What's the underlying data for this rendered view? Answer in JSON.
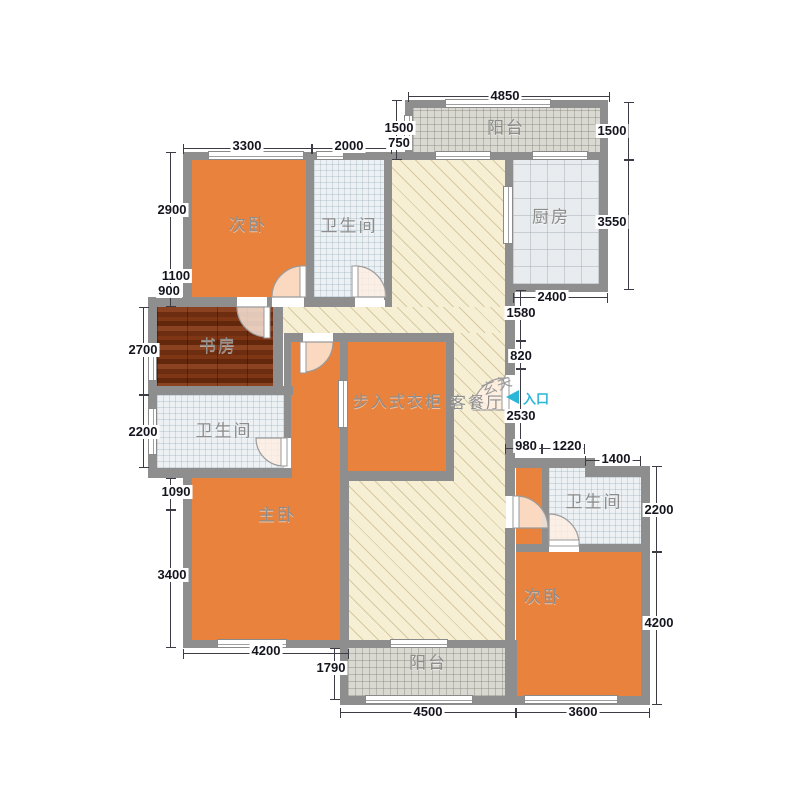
{
  "rooms": {
    "bedroom1": "次卧",
    "bath1": "卫生间",
    "balcony_top": "阳台",
    "kitchen": "厨房",
    "study": "书房",
    "bath2": "卫生间",
    "closet": "步入式衣柜",
    "living": "客餐厅",
    "foyer": "玄关",
    "entry": "入口",
    "master": "主卧",
    "bath3": "卫生间",
    "bedroom2": "次卧",
    "balcony_bottom": "阳台"
  },
  "dims": {
    "w4850": "4850",
    "h1500l": "1500",
    "h750": "750",
    "w3300": "3300",
    "w2000": "2000",
    "h1500r": "1500",
    "h2900": "2900",
    "h1100": "1100",
    "h900": "900",
    "h3550": "3550",
    "w2400": "2400",
    "h1580": "1580",
    "h2700": "2700",
    "h820": "820",
    "h2200l": "2200",
    "h2530": "2530",
    "w980": "980",
    "w1220": "1220",
    "w1400": "1400",
    "h1090": "1090",
    "h2200r": "2200",
    "h3400": "3400",
    "w4200b": "4200",
    "h1790": "1790",
    "h4200r": "4200",
    "w4500": "4500",
    "w3600": "3600"
  },
  "colors": {
    "entry_accent": "#2bb5d7"
  }
}
